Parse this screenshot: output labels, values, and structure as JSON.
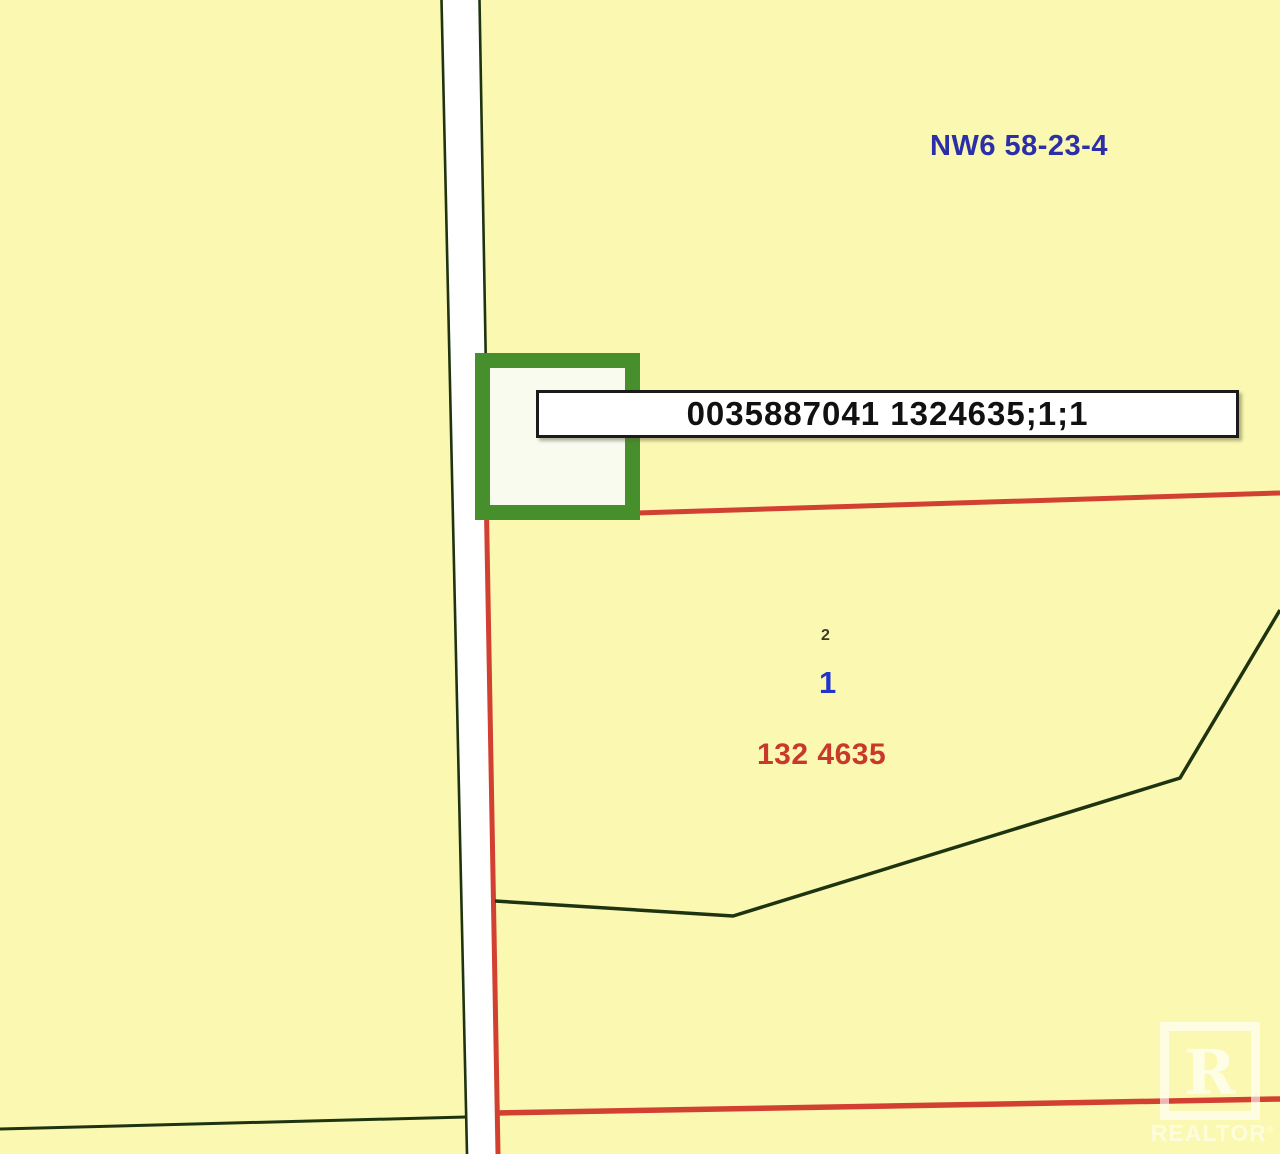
{
  "map": {
    "township_label": "NW6 58-23-4",
    "parcel_label": "0035887041 1324635;1;1",
    "lot_small_label": "2",
    "lot_number": "1",
    "plan_number": "132 4635",
    "watermark": {
      "letter": "R",
      "text": "REALTOR",
      "registered": "®"
    },
    "colors": {
      "background": "#FBF8B2",
      "road_fill": "#FFFFFF",
      "boundary_dark": "#1E330F",
      "boundary_red": "#D24031",
      "highlight_green": "#478F2C",
      "highlight_fill": "#F8FBEE",
      "township_text": "#2B2FA8",
      "lot_text": "#2334CC",
      "plan_text": "#C9392B",
      "label_text": "#111111",
      "label_box_bg": "#FFFFFF",
      "label_box_border": "#1B1B1B"
    }
  }
}
